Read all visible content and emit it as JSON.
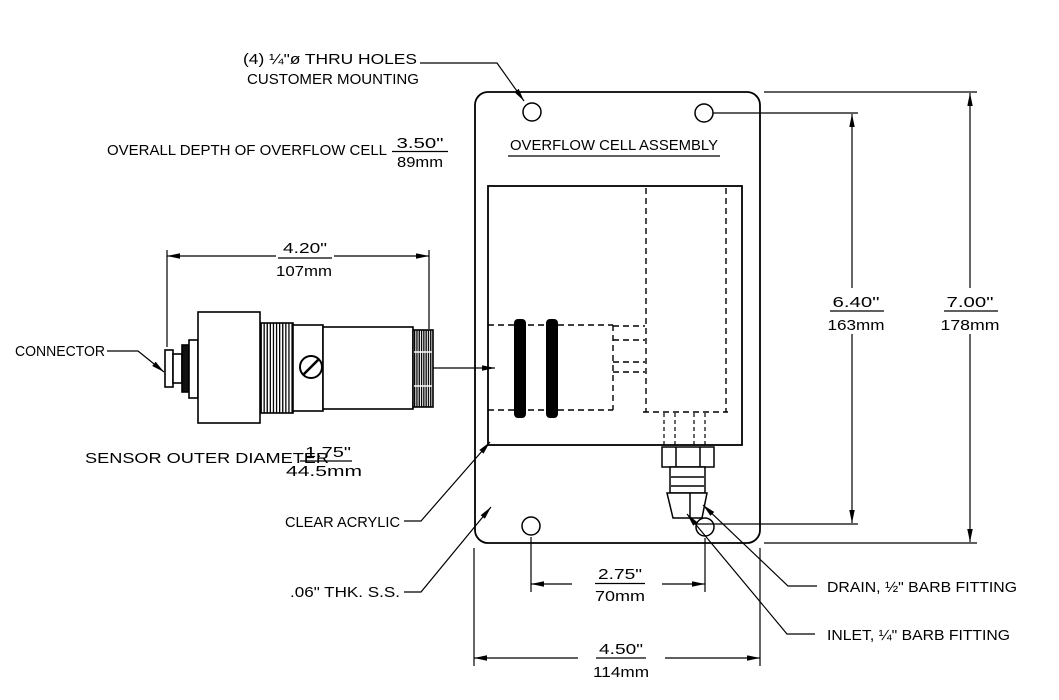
{
  "drawing": {
    "title": "OVERFLOW CELL ASSEMBLY",
    "callouts": {
      "thru_holes_line1": "(4) ¼\"ø THRU HOLES",
      "thru_holes_line2": "CUSTOMER MOUNTING",
      "overall_depth_label": "OVERALL DEPTH OF OVERFLOW CELL",
      "connector": "CONNECTOR",
      "sensor_od_label": "SENSOR OUTER DIAMETER",
      "clear_acrylic": "CLEAR ACRYLIC",
      "panel_material": ".06\" THK. S.S.",
      "drain": "DRAIN, ½\" BARB FITTING",
      "inlet": "INLET, ¼\" BARB FITTING"
    },
    "dimensions": {
      "overall_depth": {
        "in": "3.50\"",
        "mm": "89mm"
      },
      "sensor_length": {
        "in": "4.20\"",
        "mm": "107mm"
      },
      "sensor_od": {
        "in": "1.75\"",
        "mm": "44.5mm"
      },
      "bottom_hole_spacing": {
        "in": "2.75\"",
        "mm": "70mm"
      },
      "panel_width": {
        "in": "4.50\"",
        "mm": "114mm"
      },
      "hole_spacing_vertical": {
        "in": "6.40\"",
        "mm": "163mm"
      },
      "panel_height": {
        "in": "7.00\"",
        "mm": "178mm"
      }
    },
    "colors": {
      "line": "#000000",
      "background": "#ffffff"
    }
  }
}
